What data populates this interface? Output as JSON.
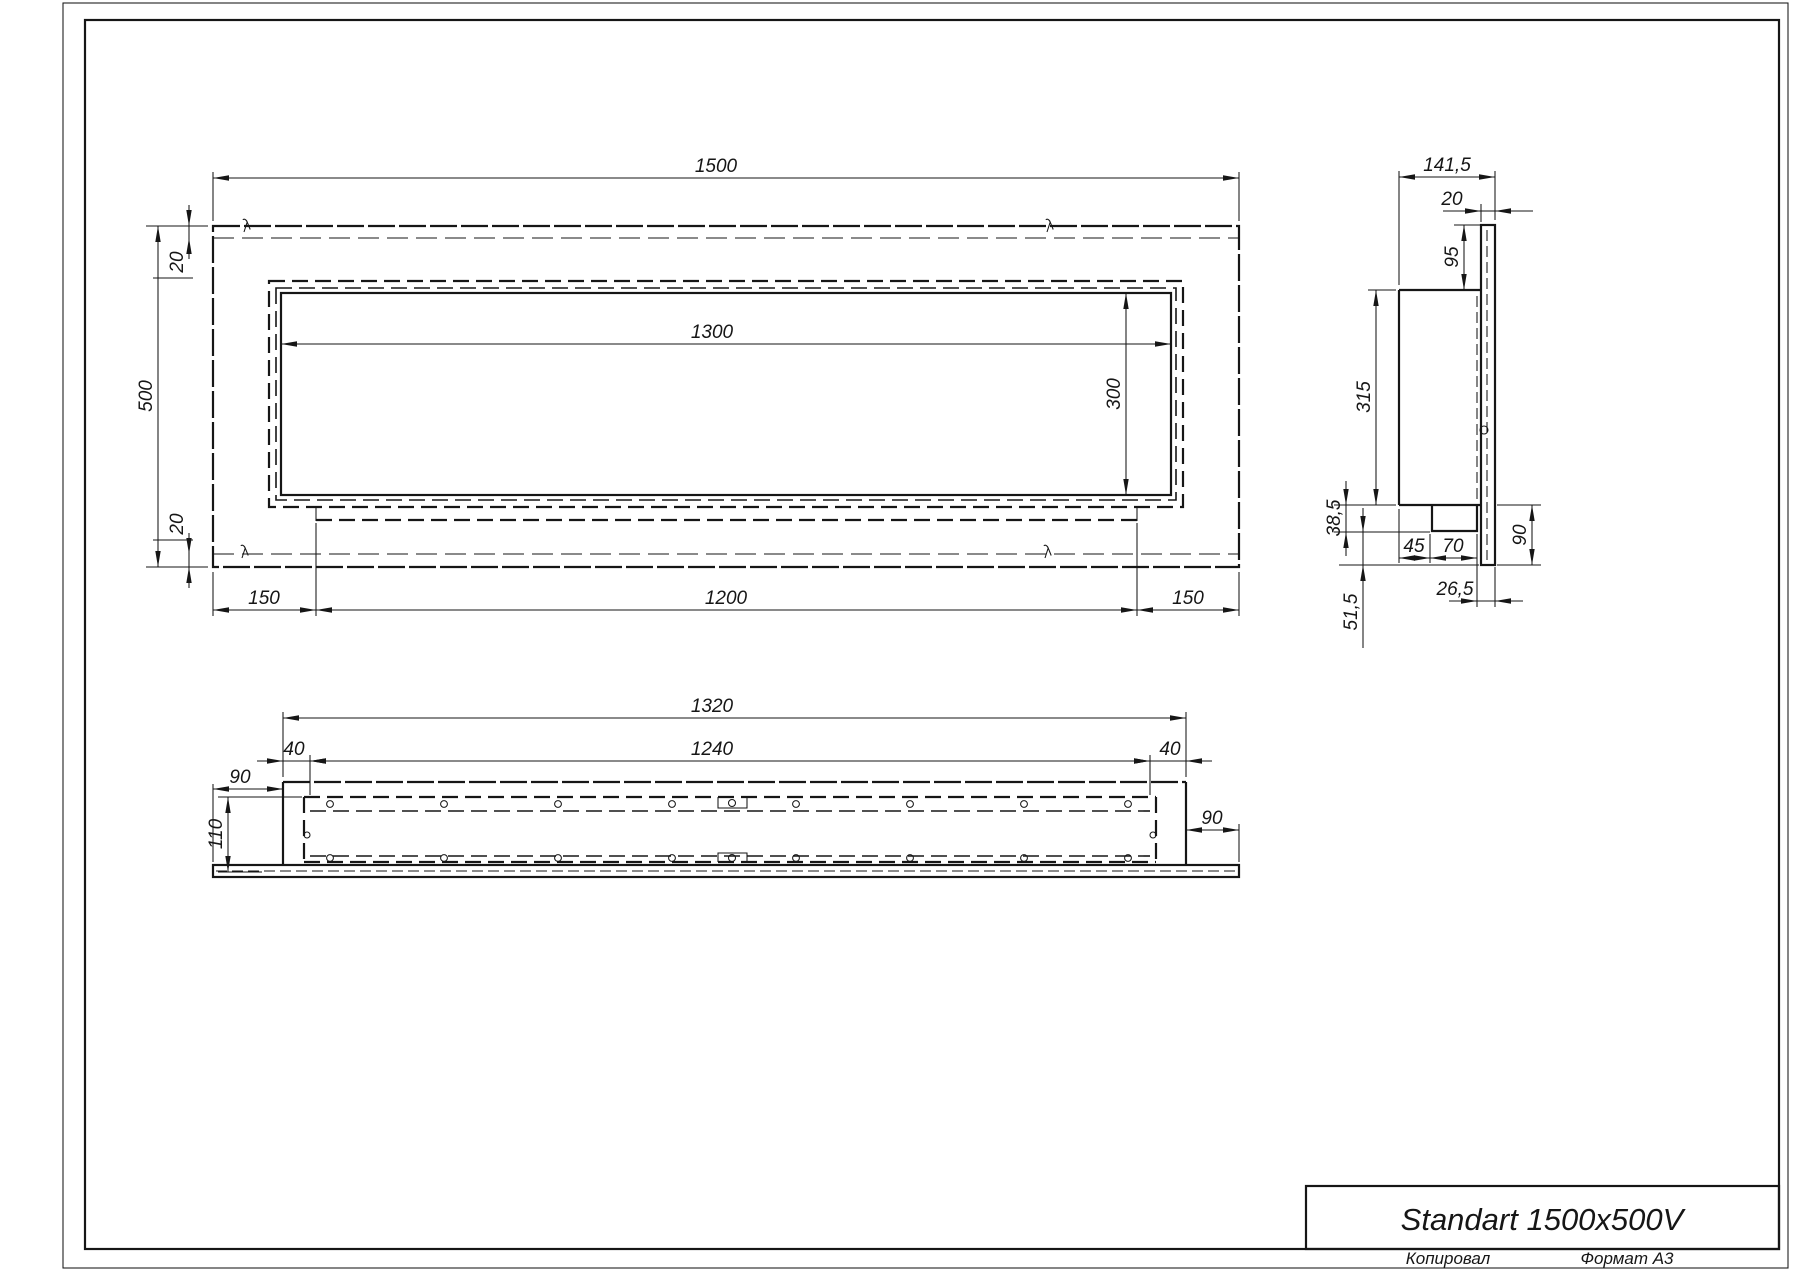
{
  "title_block": {
    "product_name": "Standart 1500x500V"
  },
  "footer": {
    "copied_label": "Копировал",
    "format_label": "Формат А3"
  },
  "front_view": {
    "width": "1500",
    "height": "500",
    "top_offset": "20",
    "bottom_offset": "20",
    "opening_width": "1300",
    "opening_height": "300",
    "left_margin": "150",
    "burner_strip": "1200",
    "right_margin": "150"
  },
  "side_view": {
    "total_depth": "141,5",
    "frame_depth": "20",
    "top_gap": "95",
    "body_height": "315",
    "tray_drop": "38,5",
    "rear_gap": "45",
    "tray_width": "70",
    "bottom_overhang": "90",
    "front_offset": "26,5",
    "lower_overhang": "51,5"
  },
  "bottom_view": {
    "body_length": "1320",
    "liner_length": "1240",
    "left_inset": "40",
    "right_inset": "40",
    "left_overhang": "90",
    "right_overhang": "90",
    "depth": "110"
  }
}
